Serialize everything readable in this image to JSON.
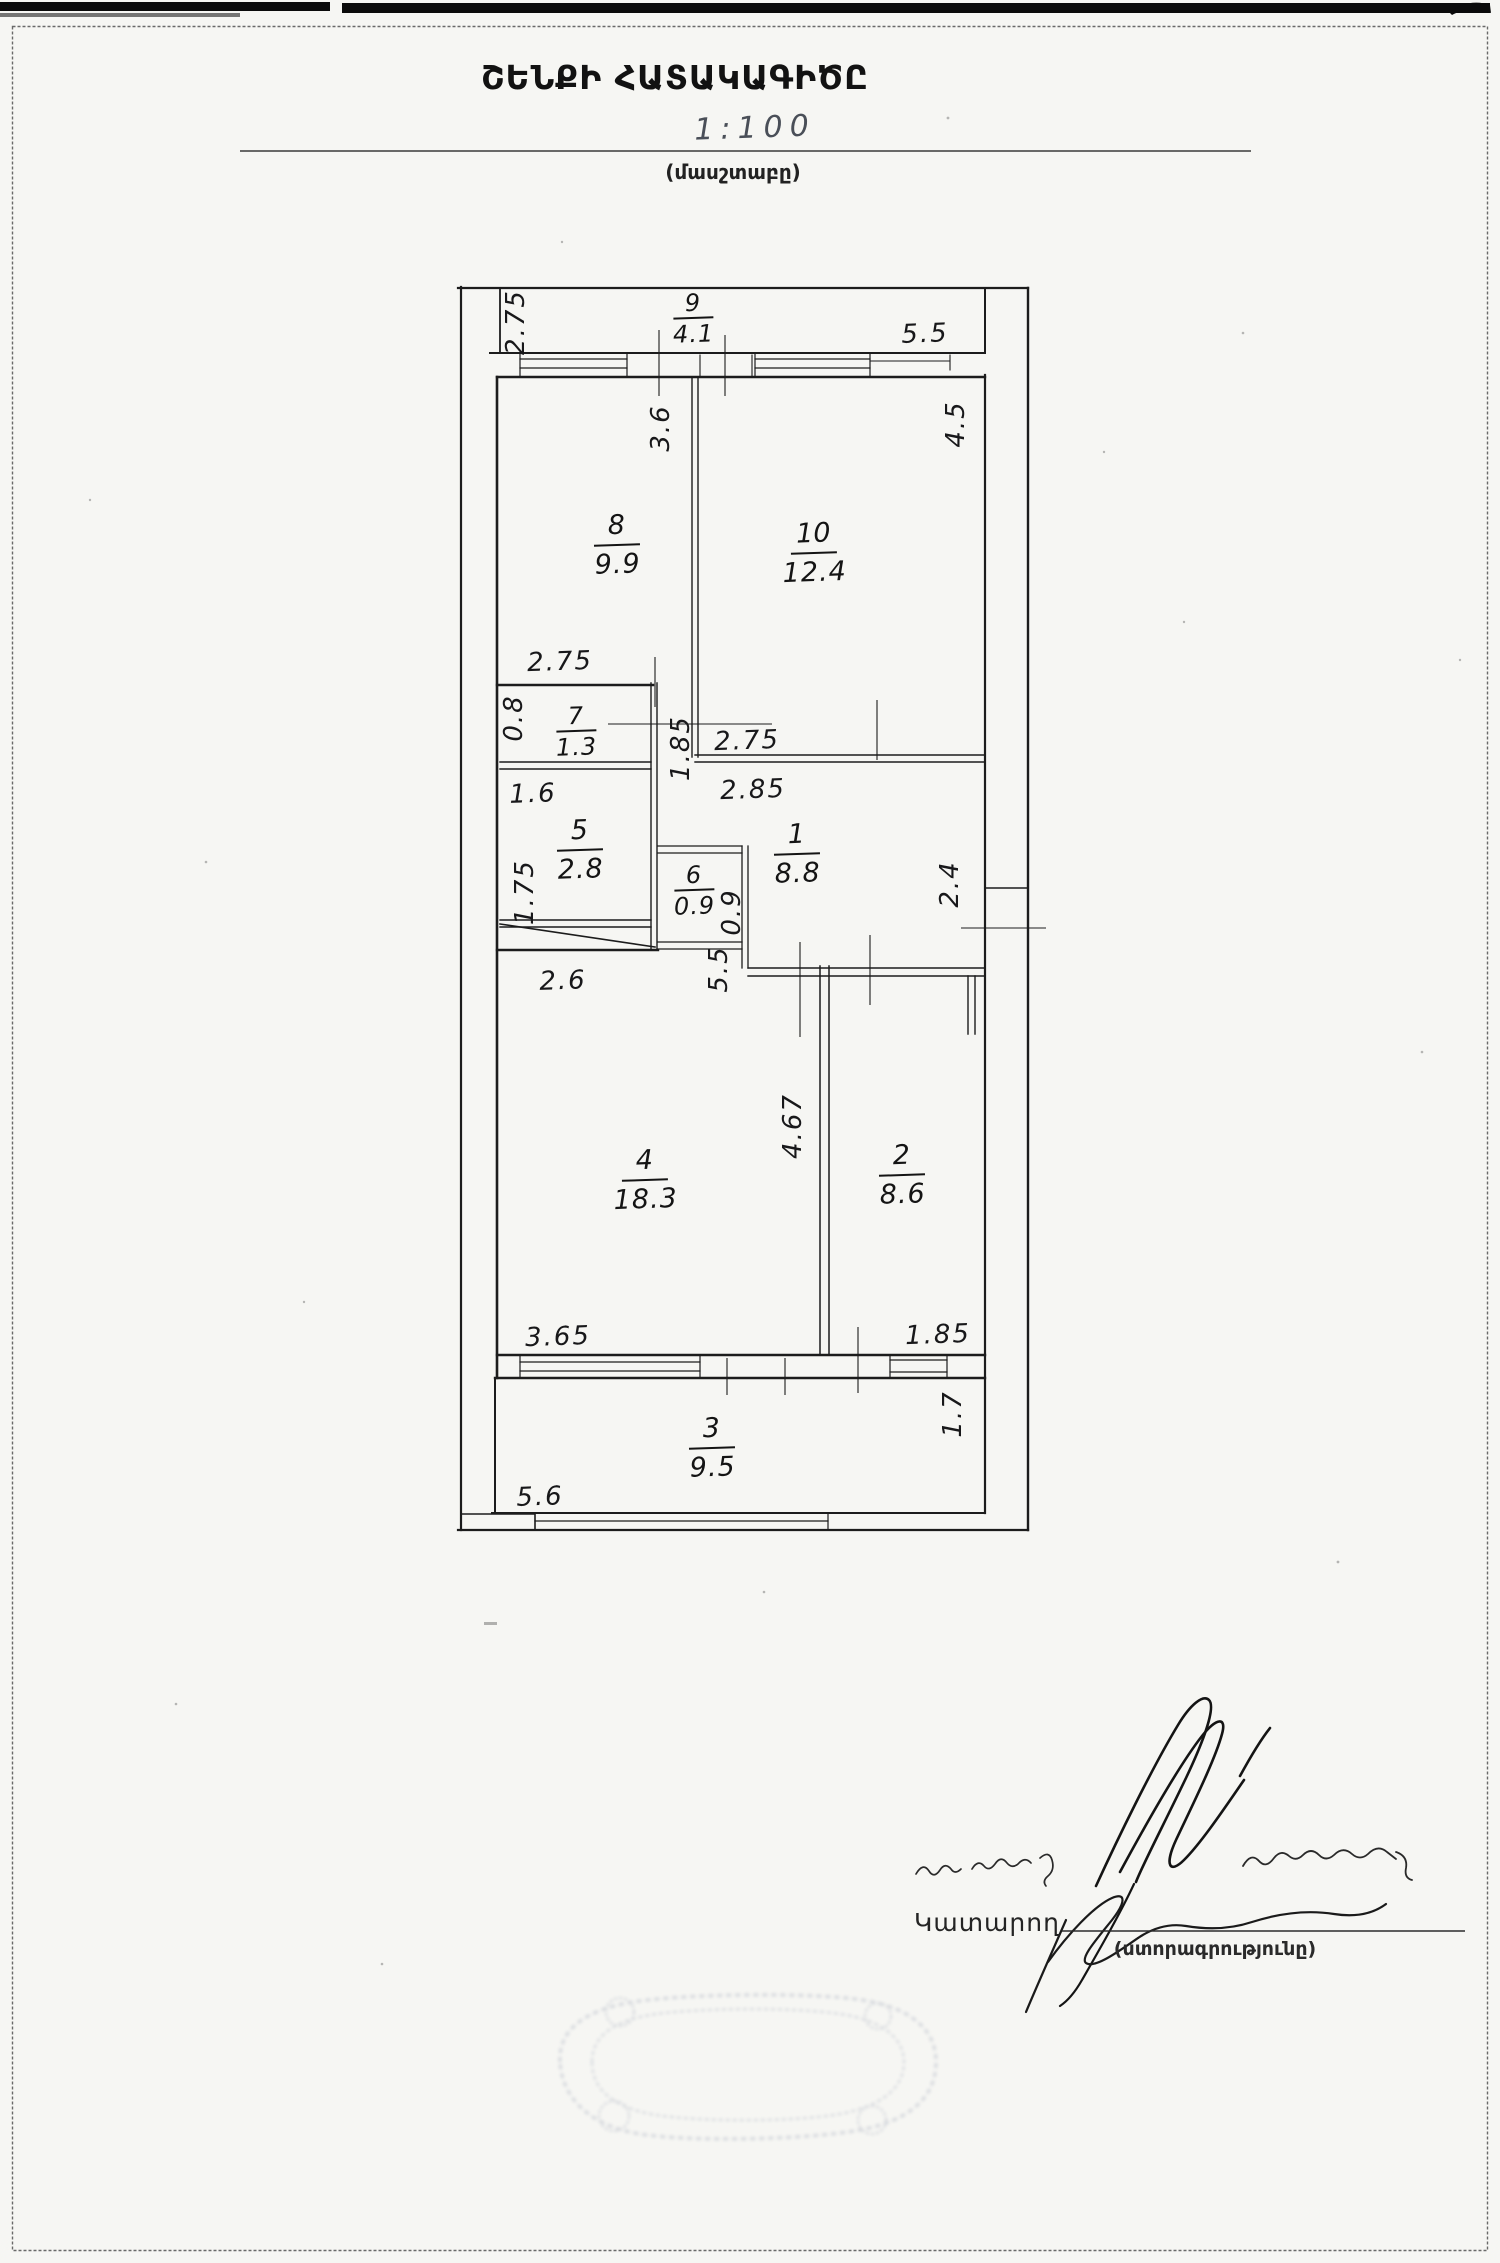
{
  "header": {
    "title": "ՇԵՆՔԻ ՀԱՏԱԿԱԳԻԾԸ",
    "scale_value": "1:100",
    "scale_caption": "(մասշտաբը)"
  },
  "plan": {
    "rooms": [
      {
        "number": "9",
        "area": "4.1"
      },
      {
        "number": "8",
        "area": "9.9"
      },
      {
        "number": "10",
        "area": "12.4"
      },
      {
        "number": "7",
        "area": "1.3"
      },
      {
        "number": "5",
        "area": "2.8"
      },
      {
        "number": "6",
        "area": "0.9"
      },
      {
        "number": "1",
        "area": "8.8"
      },
      {
        "number": "4",
        "area": "18.3"
      },
      {
        "number": "2",
        "area": "8.6"
      },
      {
        "number": "3",
        "area": "9.5"
      }
    ],
    "dims_h": [
      "5.5",
      "2.75",
      "2.75",
      "2.85",
      "1.6",
      "2.6",
      "3.65",
      "1.85",
      "5.6"
    ],
    "dims_v": [
      "2.75",
      "3.6",
      "4.5",
      "0.8",
      "1.85",
      "1.75",
      "0.9",
      "5.5",
      "2.4",
      "4.67",
      "1.7"
    ],
    "ink_color": "#1c1c1c"
  },
  "signature_block": {
    "executor_label": "Կատարող",
    "signature_caption": "(ստորագրությունը)"
  }
}
